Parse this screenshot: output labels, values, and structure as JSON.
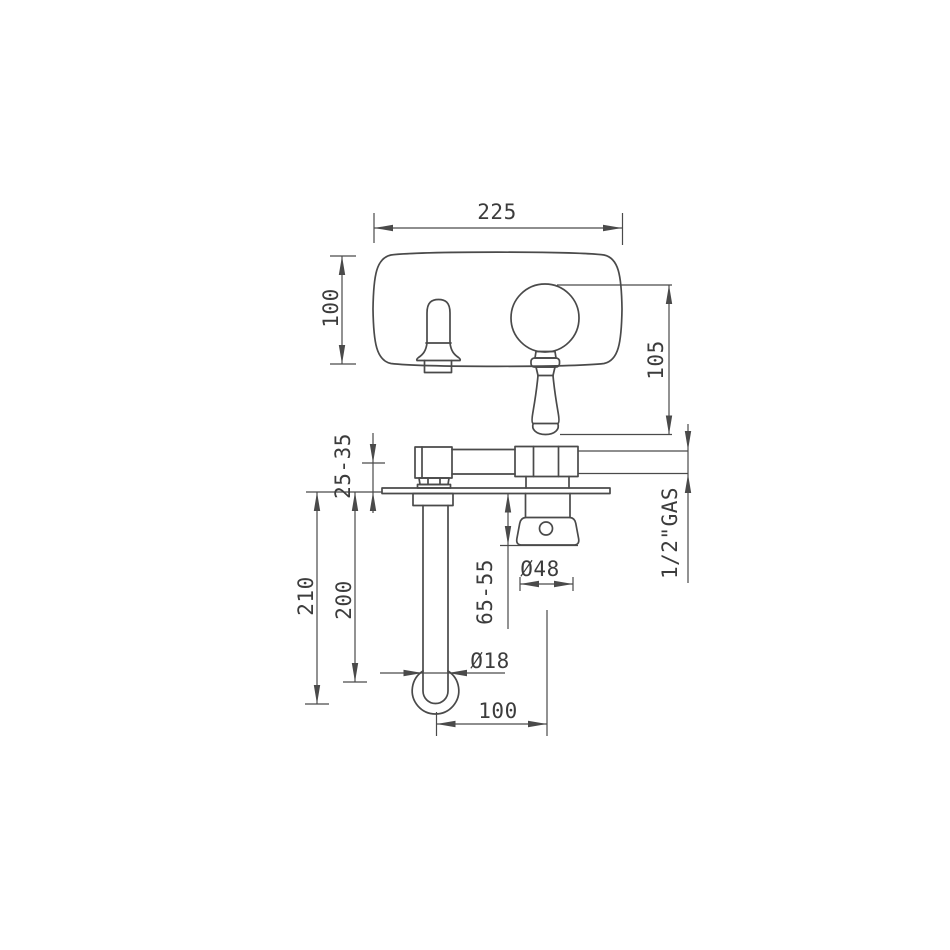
{
  "drawing": {
    "background": "#ffffff",
    "line_color": "#4a4a4a",
    "text_color": "#3c3c3c",
    "dims": {
      "plate_width": "225",
      "plate_height": "100",
      "handle_drop": "105",
      "wall_thickness": "25-35",
      "spout_total_drop": "210",
      "spout_drop": "200",
      "handle_depth": "65-55",
      "escutcheon_diameter": "Ø48",
      "connection_thread": "1/2\"GAS",
      "spout_tube_diameter": "Ø18",
      "spout_reach": "100"
    }
  }
}
